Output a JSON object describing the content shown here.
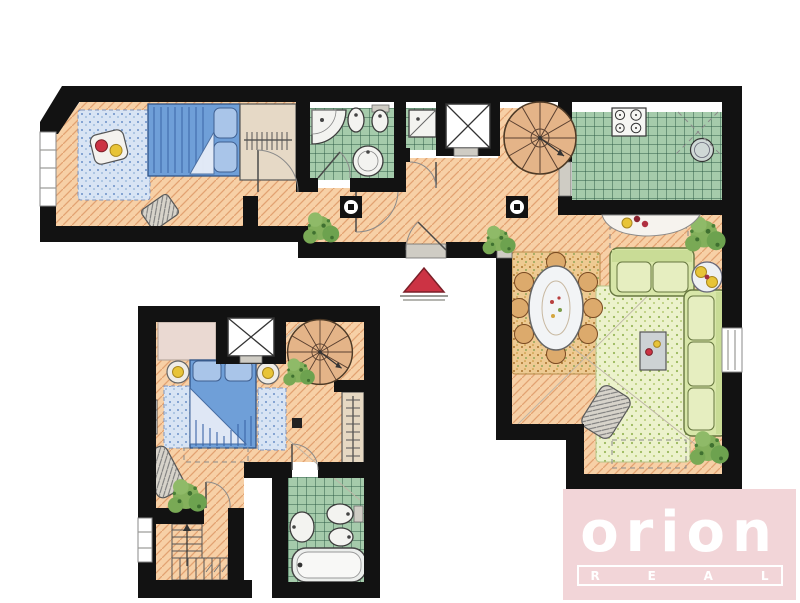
{
  "logo": {
    "brand": "orion",
    "tagline_letters": [
      "R",
      "E",
      "A",
      "L"
    ]
  },
  "colors": {
    "wall": "#121212",
    "wood_floor": "#f7d0a6",
    "wood_line": "#e2a271",
    "tile_green": "#a5cbab",
    "tile_line": "#2f5d47",
    "bed_blue": "#6f9fd8",
    "pillow_blue": "#a9c5e9",
    "rug_blue": "#d8e4f4",
    "rug_dining": "#eeca92",
    "rug_living": "#ecf2cc",
    "sofa_green": "#d8e6a8",
    "plant_green": "#6da24f",
    "stair_tan": "#e4b488",
    "accent_red": "#cc3344",
    "accent_yellow": "#e8c437",
    "logo_pink": "#f2d5d8",
    "logo_white": "#ffffff"
  },
  "floor_plan": {
    "upper_floor": {
      "name": "main-level",
      "rooms": [
        {
          "name": "bedroom",
          "furniture": [
            "double-bed",
            "blue-rug",
            "side-table",
            "chair",
            "wardrobe",
            "window"
          ]
        },
        {
          "name": "bathroom",
          "furniture": [
            "corner-shower",
            "bidet",
            "toilet",
            "round-washbasin"
          ]
        },
        {
          "name": "shower-room",
          "furniture": [
            "shower-stall"
          ]
        },
        {
          "name": "elevator",
          "furniture": [
            "elevator-cab"
          ]
        },
        {
          "name": "hallway",
          "furniture": [
            "columns",
            "spiral-staircase",
            "entrance-door",
            "plants"
          ]
        },
        {
          "name": "kitchen",
          "furniture": [
            "stove",
            "round-sink",
            "bar-counter",
            "fruit-plate"
          ]
        },
        {
          "name": "dining-area",
          "furniture": [
            "oval-table",
            "eight-chairs",
            "speckled-rug"
          ]
        },
        {
          "name": "living-room",
          "furniture": [
            "sofa",
            "corner-sofa",
            "coffee-table",
            "round-side-table",
            "armchair",
            "rug",
            "window"
          ]
        }
      ]
    },
    "lower_floor": {
      "name": "lower-level",
      "rooms": [
        {
          "name": "bedroom",
          "furniture": [
            "double-bed",
            "two-nightstands",
            "two-lamps",
            "two-blue-rugs",
            "chair",
            "wardrobe",
            "closet",
            "radiator"
          ]
        },
        {
          "name": "elevator",
          "furniture": [
            "elevator-cab"
          ]
        },
        {
          "name": "stair-hall",
          "furniture": [
            "spiral-staircase",
            "stairs-down",
            "plant"
          ]
        },
        {
          "name": "bathroom",
          "furniture": [
            "bathtub",
            "washbasin",
            "toilet",
            "bidet"
          ]
        }
      ]
    },
    "markers": {
      "entrance_marker": "red-triangle"
    }
  }
}
